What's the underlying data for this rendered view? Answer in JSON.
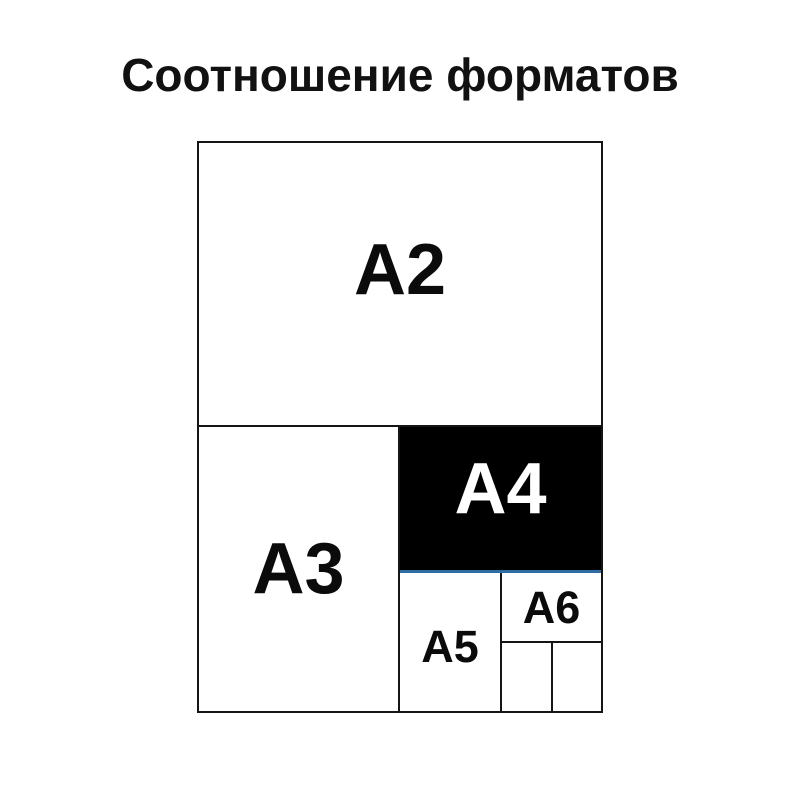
{
  "title": "Соотношение форматов",
  "diagram": {
    "description_colors": {
      "a4_fill": "#000000",
      "a4_label_color": "#ffffff",
      "accent_line_color": "#2e6da4",
      "border_color": "#151515",
      "background": "#ffffff"
    },
    "formats": [
      {
        "id": "a2",
        "label": "A2"
      },
      {
        "id": "a3",
        "label": "A3"
      },
      {
        "id": "a4",
        "label": "A4"
      },
      {
        "id": "a5",
        "label": "A5"
      },
      {
        "id": "a6",
        "label": "A6"
      }
    ]
  }
}
